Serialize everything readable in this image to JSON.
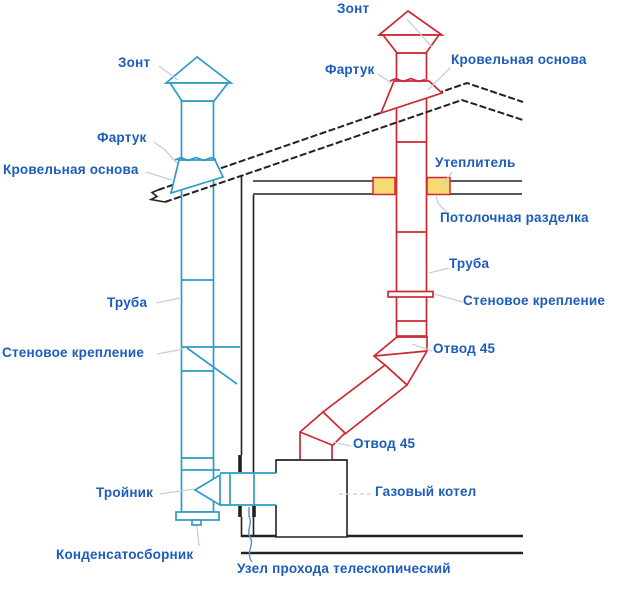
{
  "colors": {
    "blue_pipe": "#2e9bc6",
    "red_pipe": "#cc2a33",
    "label_text": "#1c5cbb",
    "structure": "#222222",
    "insulation_fill": "#f6da72",
    "insulation_border": "#cc2a33",
    "leader": "#c9ced6",
    "leader_blue": "#5b8fd0"
  },
  "diagram": {
    "blue_chimney": {
      "zont": "Зонт",
      "fartuk": "Фартук",
      "krovelnaya_osnova": "Кровельная основа",
      "truba": "Труба",
      "stenovoe_kreplenie": "Стеновое крепление",
      "troynik": "Тройник",
      "kondensatosbornik": "Конденсатосборник"
    },
    "red_chimney": {
      "zont": "Зонт",
      "fartuk": "Фартук",
      "krovelnaya_osnova": "Кровельная основа",
      "uteplitel": "Утеплитель",
      "potolochnaya_razdelka": "Потолочная разделка",
      "truba": "Труба",
      "stenovoe_kreplenie": "Стеновое крепление",
      "otvod45_upper": "Отвод 45",
      "otvod45_lower": "Отвод 45"
    },
    "boiler": {
      "gazovy_kotel": "Газовый котел"
    },
    "wall_pass": {
      "uzel_prohoda": "Узел прохода телескопический"
    }
  }
}
